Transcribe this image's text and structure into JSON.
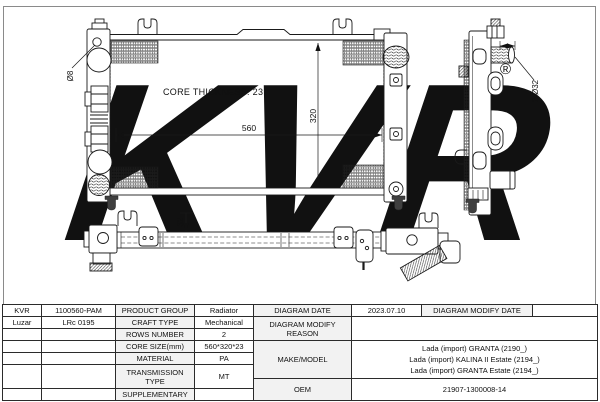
{
  "drawing": {
    "core_thickness_label": "CORE THICKNESS: 23",
    "dim_width": "560",
    "dim_height": "320",
    "dim_bar": "32",
    "dim_pipe": "2-Ø32",
    "dim_hole": "Ø8",
    "watermark": "KVR",
    "watermark_reg": "®"
  },
  "colors": {
    "line": "#1a1a1a",
    "watermark": "#ebebeb",
    "label_bg": "#f2f2f2"
  },
  "table": {
    "info_rows": [
      {
        "brand": "KVR",
        "code": "1100560-PAM",
        "label": "PRODUCT GROUP",
        "value": "Radiator"
      },
      {
        "brand": "Luzar",
        "code": "LRc 0195",
        "label": "CRAFT TYPE",
        "value": "Mechanical"
      },
      {
        "brand": "",
        "code": "",
        "label": "ROWS NUMBER",
        "value": "2"
      },
      {
        "brand": "",
        "code": "",
        "label": "CORE SIZE(mm)",
        "value": "560*320*23"
      },
      {
        "brand": "",
        "code": "",
        "label": "MATERIAL",
        "value": "PA"
      },
      {
        "brand": "",
        "code": "",
        "label": "TRANSMISSION TYPE",
        "value": "MT"
      },
      {
        "brand": "",
        "code": "",
        "label": "SUPPLEMENTARY",
        "value": ""
      }
    ],
    "diagram": {
      "date_label": "DIAGRAM DATE",
      "date_value": "2023.07.10",
      "modify_date_label": "DIAGRAM MODIFY DATE",
      "modify_date_value": "",
      "modify_reason_label": "DIAGRAM MODIFY REASON",
      "modify_reason_value": "",
      "make_model_label": "MAKE/MODEL",
      "make_model_lines": [
        "Lada (import) GRANTA (2190_)",
        "Lada (import) KALINA II Estate (2194_)",
        "Lada (import) GRANTA Estate (2194_)"
      ],
      "oem_label": "OEM",
      "oem_value": "21907-1300008-14"
    }
  }
}
